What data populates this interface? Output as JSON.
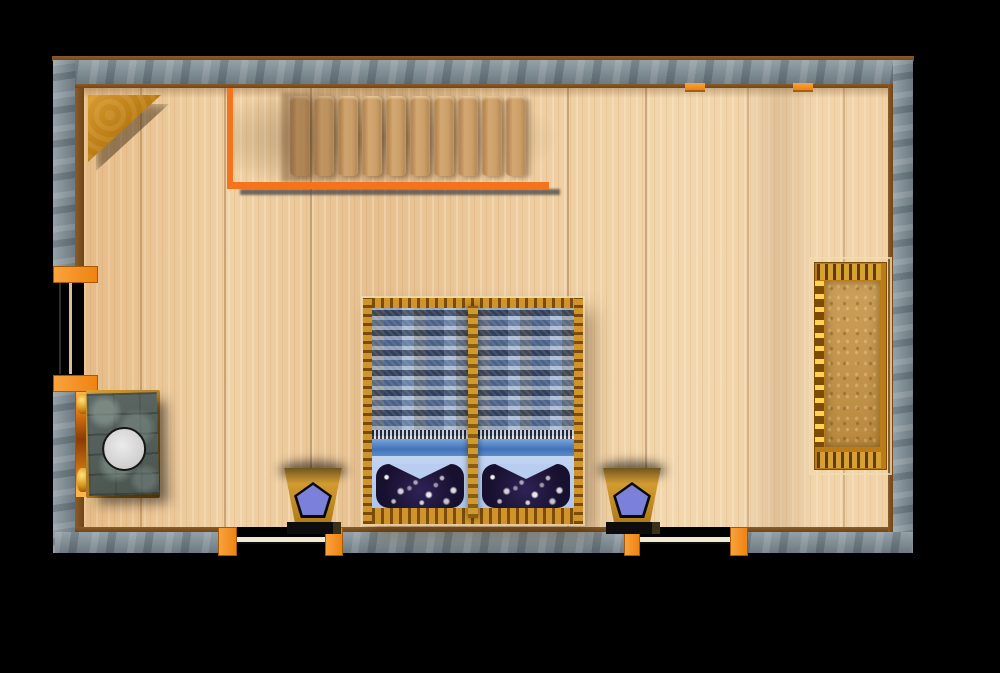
{
  "scene": {
    "title": "Bedroom floor plan (top-down 3D render)",
    "room": {
      "walls": "grey stone masonry",
      "floor": "light wood planks",
      "openings": [
        "window on left wall",
        "door bottom-left",
        "door bottom-right"
      ]
    },
    "furniture": [
      {
        "name": "staircase",
        "desc": "wooden treads along top wall with orange L-shaped railing"
      },
      {
        "name": "corner-shelf",
        "desc": "triangular wooden shelf in top-left corner"
      },
      {
        "name": "double-bed",
        "desc": "two joined single beds, blue plaid blankets, light-blue sheets, navy star pillows, gold frame"
      },
      {
        "name": "nightstand-left",
        "desc": "gold stool with blue pentagon cushion and dark base"
      },
      {
        "name": "nightstand-right",
        "desc": "gold stool with blue pentagon cushion and dark base"
      },
      {
        "name": "bench",
        "desc": "gold upholstered bench against right wall"
      },
      {
        "name": "stone-table",
        "desc": "slate table with round white plate, amber heater strip against left wall"
      },
      {
        "name": "wall-lamp-1",
        "desc": "orange fixture on top wall"
      },
      {
        "name": "wall-lamp-2",
        "desc": "orange fixture on top wall"
      }
    ]
  },
  "palette": {
    "bg": "#000000",
    "stone_a": "#95a1a8",
    "stone_b": "#6d7a81",
    "railing": "#f4731c",
    "accent": "#f7941d",
    "door_leaf": "#f2ead2",
    "pillow": "#18102f",
    "pent": "#7b80d8",
    "stand_a": "#e0a93c",
    "stand_b": "#b07a16",
    "slab_a": "#5d6864",
    "slab_b": "#49544f"
  }
}
